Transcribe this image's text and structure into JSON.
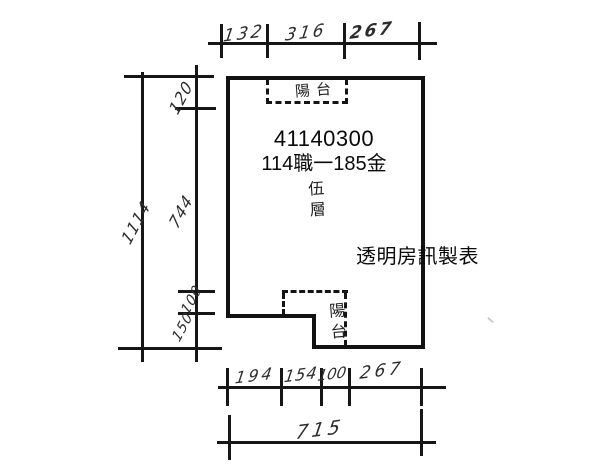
{
  "plan": {
    "unit_number": "41140300",
    "case_label": "114職一185金",
    "floor": {
      "chars": [
        "伍",
        "層"
      ]
    },
    "top_balcony_label": "陽台",
    "bottom_balcony": {
      "chars": [
        "陽",
        "台"
      ]
    },
    "watermark": "透明房訊製表"
  },
  "dimensions": {
    "top": {
      "segments": [
        "132",
        "316",
        "267"
      ]
    },
    "left": {
      "segments": [
        "120",
        "744",
        "100",
        "150"
      ],
      "total": "1114"
    },
    "bottom": {
      "segments": [
        "194",
        "154",
        "100",
        "267"
      ],
      "total": "715"
    }
  },
  "colors": {
    "line": "#161616",
    "wall": "#121212",
    "hand_text": "#2d2d2d",
    "print_text": "#0a0a0a",
    "background": "#ffffff"
  }
}
